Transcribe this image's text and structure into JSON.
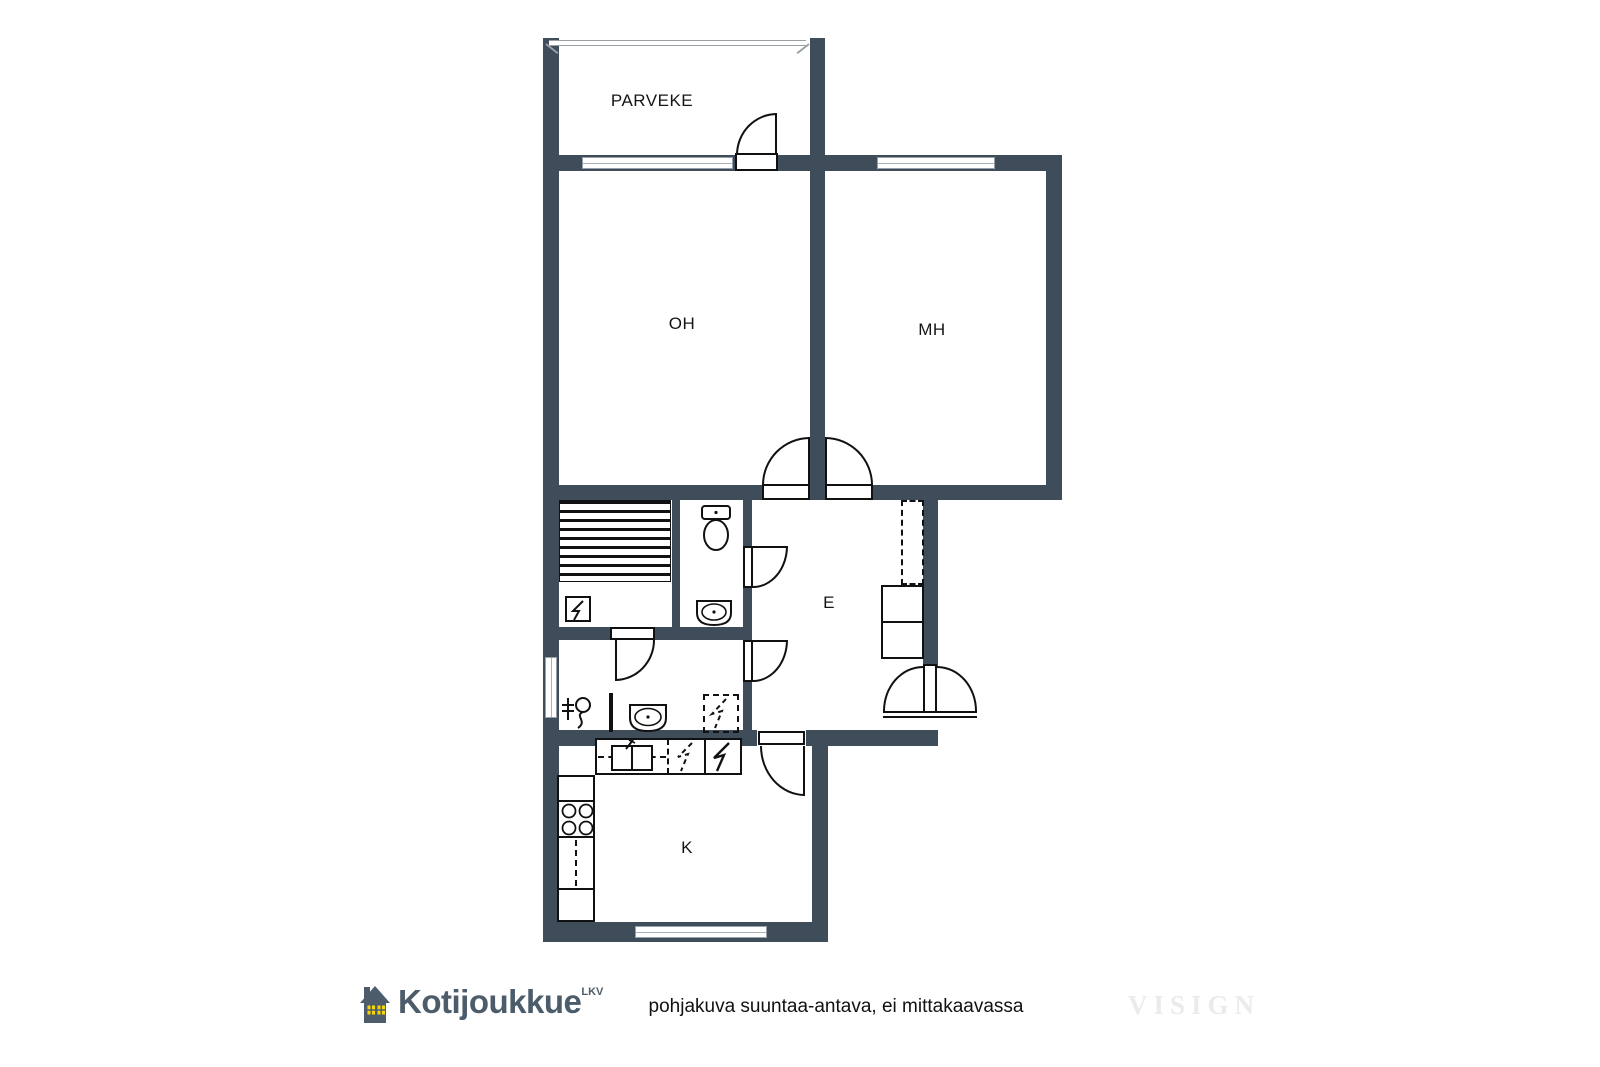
{
  "plan": {
    "rooms": {
      "balcony": "PARVEKE",
      "living": "OH",
      "bedroom": "MH",
      "entry": "E",
      "kitchen": "K"
    }
  },
  "footer": {
    "brand": "Kotijoukkue",
    "brand_suffix": "LKV",
    "disclaimer": "pohjakuva suuntaa-antava, ei mittakaavassa",
    "watermark": "VISIGN"
  },
  "colors": {
    "wall": "#3f4c59",
    "line": "#111111",
    "brand_text": "#4d5c6a",
    "brand_window": "#f7d708",
    "watermark": "#edebe9"
  }
}
